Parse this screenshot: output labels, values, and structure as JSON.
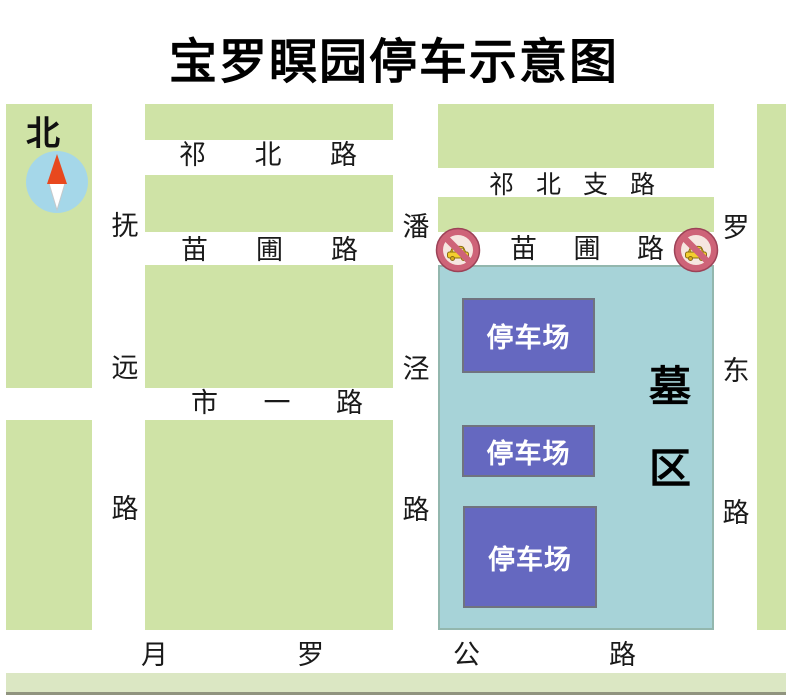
{
  "title": "宝罗瞑园停车示意图",
  "compass": {
    "north_label": "北"
  },
  "roads": {
    "qibei_road": {
      "name": "祁北路",
      "chars": [
        "祁",
        "北",
        "路"
      ]
    },
    "qibei_branch_road": {
      "name": "祁北支路",
      "chars": [
        "祁",
        "北",
        "支",
        "路"
      ]
    },
    "miaopu_road_west": {
      "name": "苗圃路",
      "chars": [
        "苗",
        "圃",
        "路"
      ]
    },
    "miaopu_road_east": {
      "name": "苗圃路",
      "chars": [
        "苗",
        "圃",
        "路"
      ]
    },
    "shiyi_road": {
      "name": "市一路",
      "chars": [
        "市",
        "一",
        "路"
      ]
    },
    "yueluo_highway": {
      "name": "月罗公路",
      "chars": [
        "月",
        "罗",
        "公",
        "路"
      ]
    },
    "fuyuan_road": {
      "name": "抚远路",
      "chars": [
        "抚",
        "远",
        "路"
      ]
    },
    "panjing_road": {
      "name": "潘泾路",
      "chars": [
        "潘",
        "泾",
        "路"
      ]
    },
    "luodong_road": {
      "name": "罗东路",
      "chars": [
        "罗",
        "东",
        "路"
      ]
    }
  },
  "cemetery": {
    "name": "墓区",
    "label_chars": [
      "墓",
      "区"
    ]
  },
  "parking_lots": [
    {
      "label": "停车场"
    },
    {
      "label": "停车场"
    },
    {
      "label": "停车场"
    }
  ],
  "signs": {
    "no_entry_for_vehicles_count": 2
  },
  "colors": {
    "green_block": "#cfe3a6",
    "cemetery_blue": "#a7d3d8",
    "parking_purple": "#6568c0",
    "sign_ring_pink": "#ce6378",
    "sign_car_yellow": "#f3cf2e",
    "compass_blue": "#a5d7e9",
    "compass_red": "#e8481e"
  }
}
